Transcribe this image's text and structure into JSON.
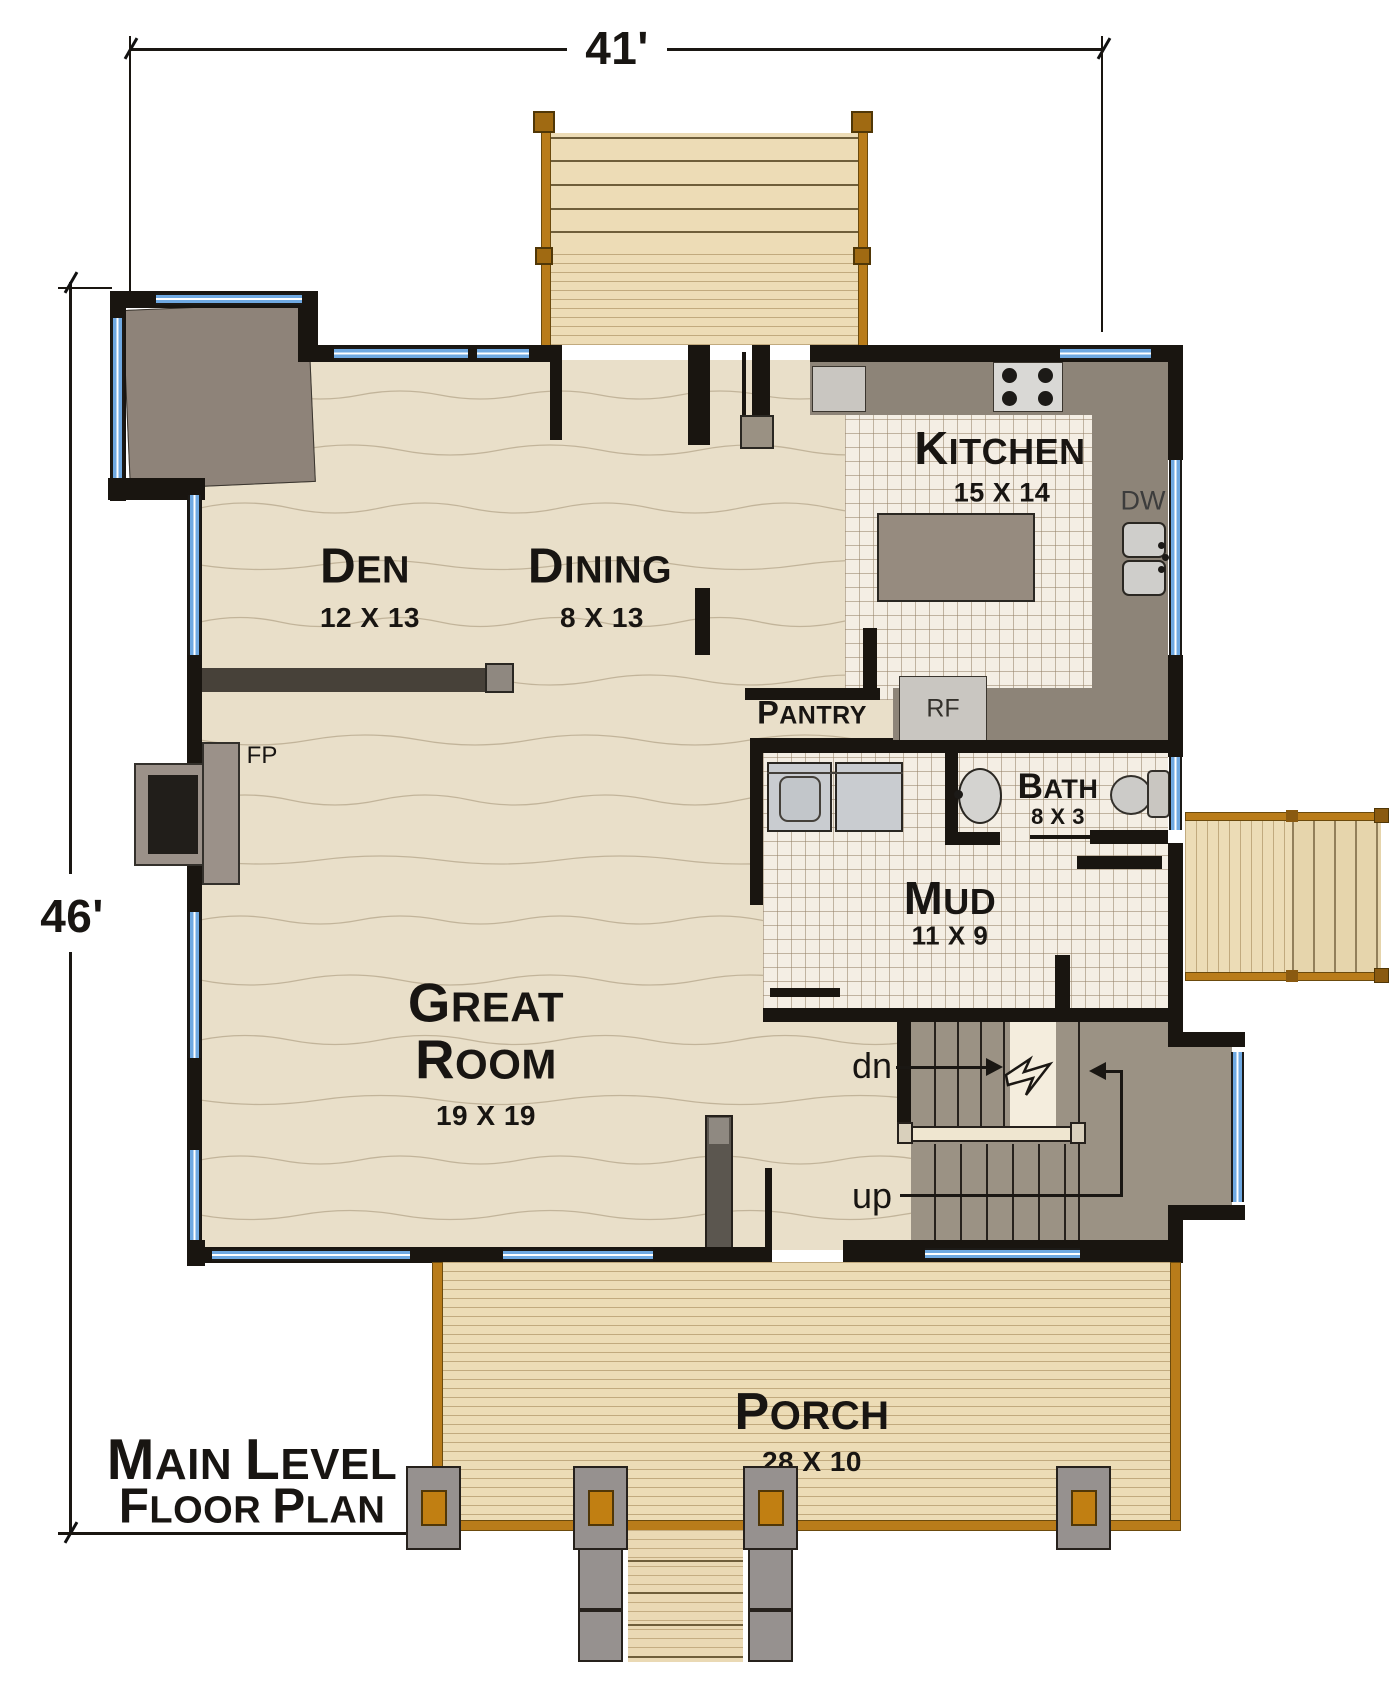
{
  "dimensions": {
    "width_label": "41'",
    "height_label": "46'"
  },
  "title": {
    "line1": "Main Level",
    "line2": "Floor Plan"
  },
  "rooms": {
    "den": {
      "name": "Den",
      "size": "12 X 13"
    },
    "dining": {
      "name": "Dining",
      "size": "8 X 13"
    },
    "kitchen": {
      "name": "Kitchen",
      "size": "15 X 14"
    },
    "pantry": {
      "name": "Pantry"
    },
    "bath": {
      "name": "Bath",
      "size": "8 X 3"
    },
    "mud": {
      "name": "Mud",
      "size": "11 X 9"
    },
    "great_room": {
      "name": "Great Room",
      "size": "19 X 19"
    },
    "porch": {
      "name": "Porch",
      "size": "28 X 10"
    }
  },
  "annotations": {
    "fireplace": "FP",
    "dishwasher": "DW",
    "refrigerator": "RF",
    "stairs_down": "dn",
    "stairs_up": "up"
  },
  "colors": {
    "wall": "#191510",
    "window_blue": "#6fa9e2",
    "wood_floor": "#e9dfc9",
    "tile_floor": "#f4eee4",
    "porch_wood": "#ecdcb6",
    "counter_gray": "#8d8478",
    "stair_gray": "#9b9284",
    "rail_orange": "#b97c1a"
  }
}
